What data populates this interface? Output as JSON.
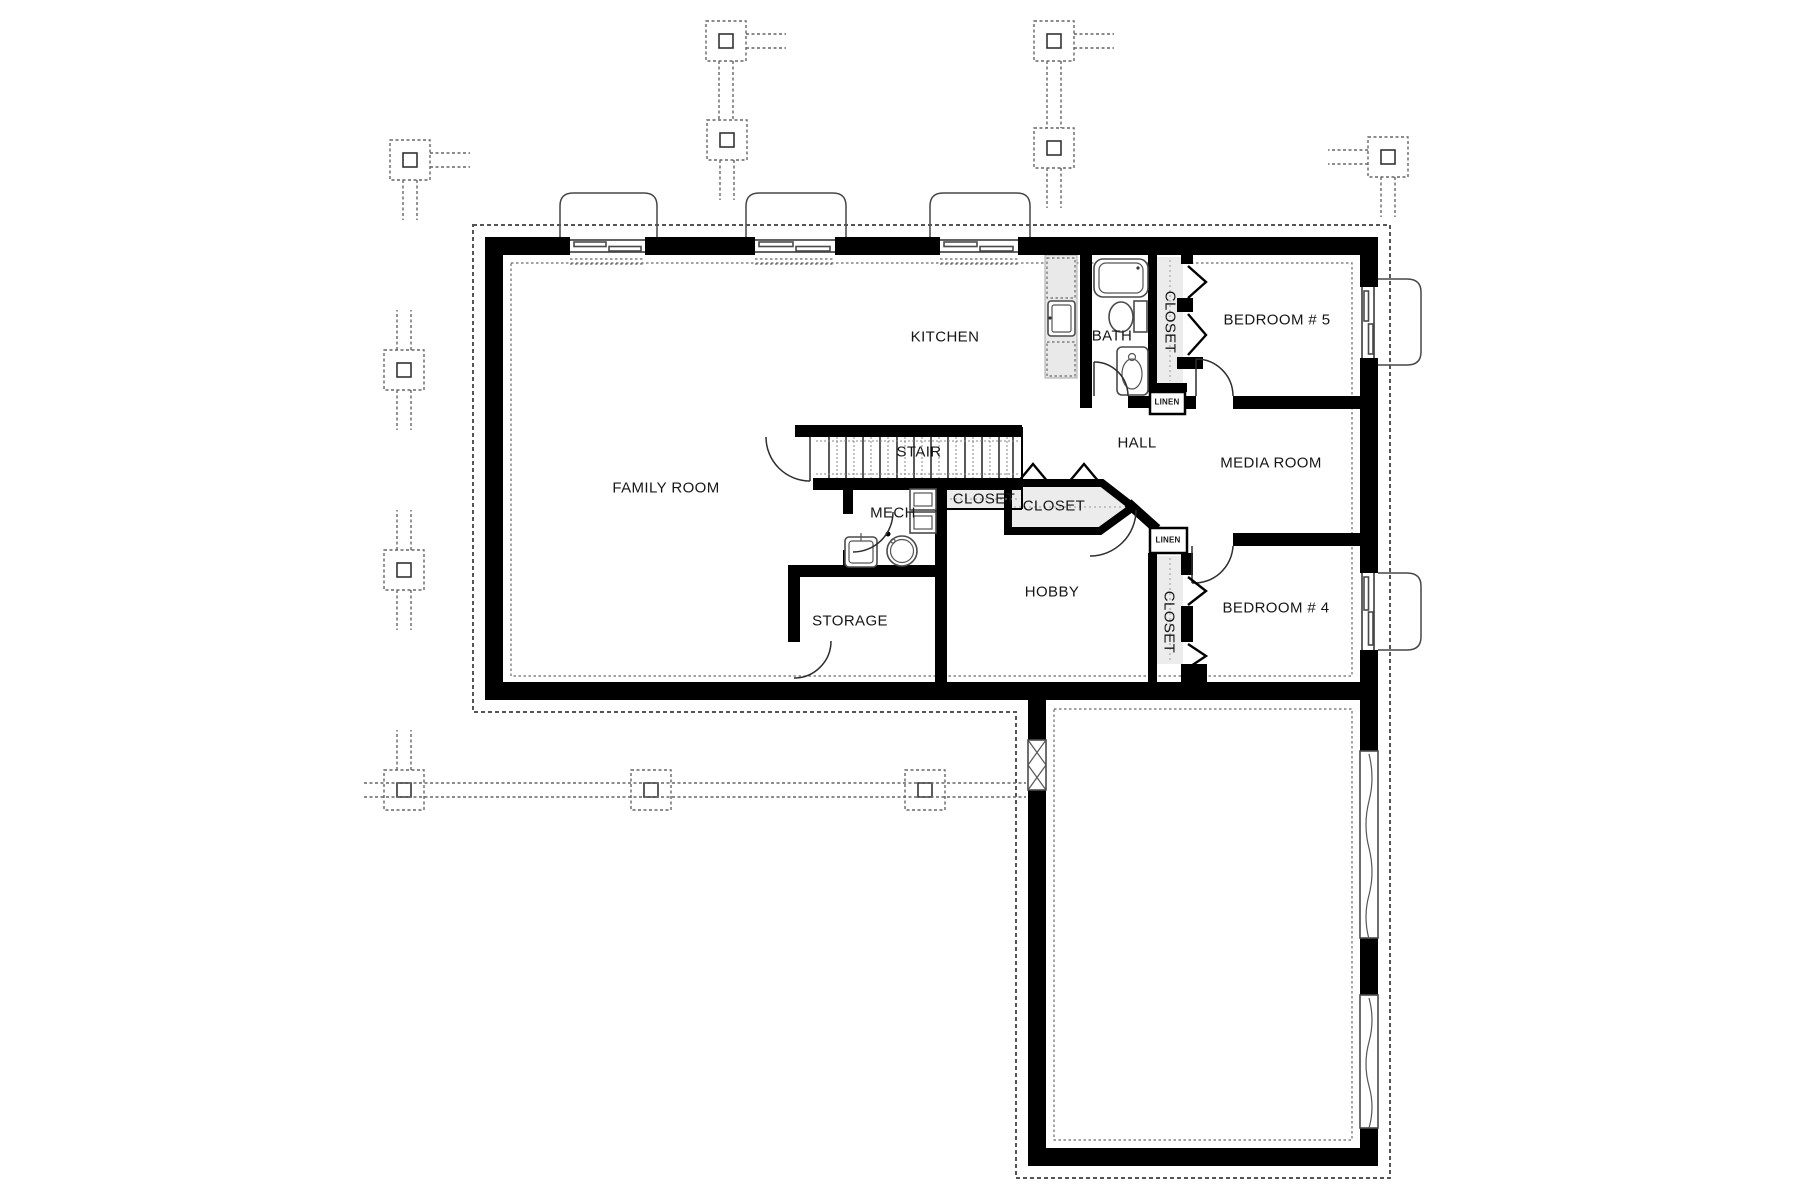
{
  "canvas": {
    "width": 1799,
    "height": 1200,
    "background": "#ffffff"
  },
  "colors": {
    "wall": "#000000",
    "line": "#4a4a4a",
    "closet_fill": "#ececec",
    "counter_fill": "#e9e9e9",
    "dash": "#666666",
    "text": "#161616"
  },
  "rooms": {
    "family_room": {
      "label": "FAMILY ROOM"
    },
    "kitchen": {
      "label": "KITCHEN"
    },
    "bath": {
      "label": "BATH"
    },
    "stair": {
      "label": "STAIR"
    },
    "hall": {
      "label": "HALL"
    },
    "media_room": {
      "label": "MEDIA ROOM"
    },
    "bedroom5": {
      "label": "BEDROOM # 5"
    },
    "bedroom4": {
      "label": "BEDROOM # 4"
    },
    "hobby": {
      "label": "HOBBY"
    },
    "storage": {
      "label": "STORAGE"
    },
    "mech": {
      "label": "MECH"
    },
    "closet_bedroom5": {
      "label": "CLOSET"
    },
    "closet_bedroom4": {
      "label": "CLOSET"
    },
    "closet_hall": {
      "label": "CLOSET"
    },
    "closet_understair": {
      "label": "CLOSET"
    },
    "linen_hall": {
      "label": "LINEN"
    },
    "linen_bedroom4": {
      "label": "LINEN"
    }
  },
  "symbols": {
    "pier_footings": 11,
    "window_wells": 5,
    "fixtures": [
      "bathtub",
      "toilet",
      "shower",
      "kitchen-sink",
      "dishwasher",
      "refrigerator",
      "laundry-sink",
      "water-heater",
      "furnace",
      "floor-drain",
      "stair-treads"
    ]
  }
}
